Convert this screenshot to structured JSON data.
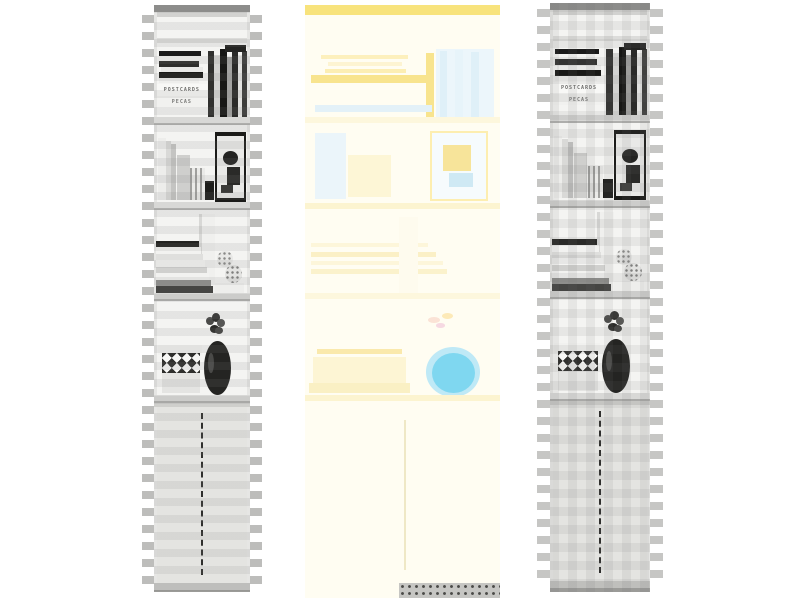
{
  "meta": {
    "description": "Photograph of a tall white bookcase shown as three side-by-side variants: left grayscale copy with horizontal block-stripe artifacts, center an over-exposed faded color copy with a yellow band at top and a cyan vase blob, right grayscale copy with checkerboard block artifacts",
    "canvas": {
      "width": 800,
      "height": 600,
      "background": "#ffffff"
    }
  },
  "palette": {
    "page_background": "#ffffff",
    "faded_cream": "#fffdf2",
    "accent_yellow": "#f8e37c",
    "vase_cyan": "#7fd7f0",
    "grayscale_light": "#f2f2f0",
    "artifact_gray": "#bdbdbb"
  },
  "photo_text": {
    "postcards_spine": "POSTCARDS",
    "pecas_spine": "PECAS"
  },
  "panels": [
    {
      "id": "left",
      "name": "bookcase-photo-grayscale-left",
      "x": 154,
      "y": 5,
      "w": 96,
      "h": 587,
      "background": "#f4f4f2",
      "items_ref": "bookcase_items",
      "overlay": "ov-hbands",
      "edge_stripes": {
        "start": 10,
        "period": 17,
        "h": 8,
        "extend": 12,
        "color": "#bdbdbb"
      }
    },
    {
      "id": "center",
      "name": "bookcase-photo-faded-center",
      "x": 305,
      "y": 5,
      "w": 195,
      "h": 593,
      "background": "#fffdf2",
      "items_ref": "faded_items",
      "overlay": null,
      "edge_stripes": null
    },
    {
      "id": "right",
      "name": "bookcase-photo-grayscale-right",
      "x": 550,
      "y": 3,
      "w": 100,
      "h": 589,
      "background": "#f4f4f2",
      "items_ref": "bookcase_items",
      "overlay": "ov-checker",
      "edge_stripes": {
        "start": 6,
        "period": 17,
        "h": 8,
        "extend": 13,
        "color": "#c6c6c4"
      }
    }
  ],
  "scene": {
    "bookcase_items": [
      {
        "n": "carcass-bg",
        "t": "rect",
        "x": 0,
        "y": 0,
        "w": 100,
        "h": 587,
        "c": "#f4f4f2"
      },
      {
        "n": "top-bar",
        "t": "rect",
        "x": 0,
        "y": 0,
        "w": 100,
        "h": 7,
        "c": "#8f8f8d"
      },
      {
        "n": "cornice-shadow",
        "t": "rect",
        "x": 0,
        "y": 7,
        "w": 100,
        "h": 5,
        "c": "#d2d2d0"
      },
      {
        "n": "top-board",
        "t": "rect",
        "x": 0,
        "y": 33,
        "w": 100,
        "h": 5,
        "c": "#dcdcda"
      },
      {
        "n": "side-wall-left",
        "t": "rect",
        "x": 0,
        "y": 7,
        "w": 3,
        "h": 580,
        "c": "#e6e6e4"
      },
      {
        "n": "side-wall-right",
        "t": "rect",
        "x": 97,
        "y": 7,
        "w": 3,
        "h": 580,
        "c": "#e6e6e4"
      },
      {
        "n": "hbook-1",
        "t": "rect",
        "x": 5,
        "y": 46,
        "w": 44,
        "h": 5,
        "c": "#1a1a1a"
      },
      {
        "n": "hbook-2",
        "t": "rect",
        "x": 5,
        "y": 51,
        "w": 46,
        "h": 5,
        "c": "#f3f3f1"
      },
      {
        "n": "hbook-3",
        "t": "rect",
        "x": 5,
        "y": 56,
        "w": 42,
        "h": 6,
        "c": "#2e2e2c"
      },
      {
        "n": "hbook-4",
        "t": "rect",
        "x": 7,
        "y": 62,
        "w": 44,
        "h": 5,
        "c": "#e9e9e7"
      },
      {
        "n": "hbook-5",
        "t": "rect",
        "x": 5,
        "y": 67,
        "w": 46,
        "h": 6,
        "c": "#191917"
      },
      {
        "n": "hbook-6",
        "t": "rect",
        "x": 5,
        "y": 73,
        "w": 42,
        "h": 5,
        "c": "#eeeeec"
      },
      {
        "n": "postcards-box",
        "t": "text",
        "x": 3,
        "y": 79,
        "w": 52,
        "h": 12,
        "c": "#f8f8f6",
        "c2": "#6e6e6c",
        "ref": "photo_text.postcards_spine",
        "fs": 5
      },
      {
        "n": "pecas-box",
        "t": "text",
        "x": 3,
        "y": 91,
        "w": 52,
        "h": 11,
        "c": "#f1f1ef",
        "c2": "#7a7a78",
        "ref": "photo_text.pecas_spine",
        "fs": 5
      },
      {
        "n": "vbook-1",
        "t": "rect",
        "x": 56,
        "y": 46,
        "w": 7,
        "h": 66,
        "c": "#30302e"
      },
      {
        "n": "vbook-2",
        "t": "rect",
        "x": 63,
        "y": 50,
        "w": 6,
        "h": 62,
        "c": "#d3d3d1"
      },
      {
        "n": "vbook-3",
        "t": "rect",
        "x": 69,
        "y": 44,
        "w": 7,
        "h": 68,
        "c": "#171715"
      },
      {
        "n": "vbook-4",
        "t": "rect",
        "x": 76,
        "y": 52,
        "w": 5,
        "h": 60,
        "c": "#a3a3a1"
      },
      {
        "n": "vbook-5",
        "t": "rect",
        "x": 81,
        "y": 47,
        "w": 6,
        "h": 65,
        "c": "#2b2b29"
      },
      {
        "n": "vbook-6",
        "t": "rect",
        "x": 87,
        "y": 50,
        "w": 5,
        "h": 62,
        "c": "#e2e2e0"
      },
      {
        "n": "vbook-7",
        "t": "rect",
        "x": 92,
        "y": 46,
        "w": 5,
        "h": 66,
        "c": "#3d3d3b"
      },
      {
        "n": "shelf1-top-box",
        "t": "rect",
        "x": 74,
        "y": 40,
        "w": 22,
        "h": 7,
        "c": "#242422"
      },
      {
        "n": "shelf-board-1",
        "t": "rect",
        "x": 0,
        "y": 112,
        "w": 100,
        "h": 8,
        "c": "#d8d8d6"
      },
      {
        "n": "shelf-board-1-edge",
        "t": "rect",
        "x": 0,
        "y": 118,
        "w": 100,
        "h": 2,
        "c": "#aeaeac"
      },
      {
        "n": "folder-1",
        "t": "rect",
        "x": 4,
        "y": 133,
        "w": 8,
        "h": 62,
        "c": "#ededeb"
      },
      {
        "n": "folder-2",
        "t": "rect",
        "x": 12,
        "y": 136,
        "w": 6,
        "h": 59,
        "c": "#d9d9d7"
      },
      {
        "n": "folder-3",
        "t": "rect",
        "x": 18,
        "y": 139,
        "w": 5,
        "h": 56,
        "c": "#c4c4c2"
      },
      {
        "n": "small-frame",
        "t": "rect",
        "x": 24,
        "y": 150,
        "w": 13,
        "h": 45,
        "c": "#cfcfcd"
      },
      {
        "n": "wire-rack",
        "t": "vstripes",
        "x": 38,
        "y": 163,
        "w": 15,
        "h": 32,
        "c": "#9f9f9d",
        "c2": "#eaeae8"
      },
      {
        "n": "dark-ornament",
        "t": "rect",
        "x": 53,
        "y": 176,
        "w": 10,
        "h": 19,
        "c": "#1d1d1b"
      },
      {
        "n": "big-frame-border",
        "t": "rect",
        "x": 64,
        "y": 127,
        "w": 32,
        "h": 70,
        "c": "#1b1b19"
      },
      {
        "n": "big-frame-mat",
        "t": "rect",
        "x": 66,
        "y": 131,
        "w": 28,
        "h": 62,
        "c": "#e9e9e7"
      },
      {
        "n": "frame-art-blob-1",
        "t": "ellipse",
        "x": 72,
        "y": 146,
        "w": 16,
        "h": 14,
        "c": "#232321"
      },
      {
        "n": "frame-art-blob-2",
        "t": "rect",
        "x": 76,
        "y": 162,
        "w": 14,
        "h": 18,
        "c": "#2a2a28"
      },
      {
        "n": "frame-art-blob-3",
        "t": "rect",
        "x": 70,
        "y": 180,
        "w": 12,
        "h": 8,
        "c": "#3a3a38"
      },
      {
        "n": "shelf-board-2",
        "t": "rect",
        "x": 0,
        "y": 197,
        "w": 100,
        "h": 8,
        "c": "#d8d8d6"
      },
      {
        "n": "shelf-board-2-edge",
        "t": "rect",
        "x": 0,
        "y": 203,
        "w": 100,
        "h": 2,
        "c": "#aeaeac"
      },
      {
        "n": "white-cylinder",
        "t": "rect",
        "x": 47,
        "y": 209,
        "w": 17,
        "h": 80,
        "c": "#f0f0ee"
      },
      {
        "n": "cylinder-shade",
        "t": "rect",
        "x": 47,
        "y": 209,
        "w": 3,
        "h": 80,
        "c": "#d8d8d6"
      },
      {
        "n": "stacked-book-1",
        "t": "rect",
        "x": 2,
        "y": 236,
        "w": 45,
        "h": 6,
        "c": "#222220"
      },
      {
        "n": "stacked-book-2",
        "t": "rect",
        "x": 2,
        "y": 242,
        "w": 47,
        "h": 7,
        "c": "#f2f2f0"
      },
      {
        "n": "stacked-book-3",
        "t": "rect",
        "x": 2,
        "y": 249,
        "w": 49,
        "h": 6,
        "c": "#dfdfdd"
      },
      {
        "n": "stacked-book-4",
        "t": "rect",
        "x": 2,
        "y": 255,
        "w": 51,
        "h": 7,
        "c": "#f5f5f3"
      },
      {
        "n": "stacked-book-5",
        "t": "rect",
        "x": 2,
        "y": 262,
        "w": 53,
        "h": 6,
        "c": "#d0d0ce"
      },
      {
        "n": "stacked-book-6",
        "t": "rect",
        "x": 2,
        "y": 268,
        "w": 55,
        "h": 7,
        "c": "#f2f2f0"
      },
      {
        "n": "stacked-book-7",
        "t": "rect",
        "x": 2,
        "y": 275,
        "w": 57,
        "h": 6,
        "c": "#8e8e8c"
      },
      {
        "n": "stacked-book-8",
        "t": "rect",
        "x": 2,
        "y": 281,
        "w": 59,
        "h": 7,
        "c": "#454543"
      },
      {
        "n": "patterned-ball-1",
        "t": "dotball",
        "x": 66,
        "y": 246,
        "w": 16,
        "h": 16,
        "c": "#e8e8e6",
        "c2": "#8a8a88"
      },
      {
        "n": "patterned-ball-2",
        "t": "dotball",
        "x": 74,
        "y": 260,
        "w": 18,
        "h": 18,
        "c": "#e3e3e1",
        "c2": "#7e7e7c"
      },
      {
        "n": "white-stack",
        "t": "rect",
        "x": 64,
        "y": 278,
        "w": 30,
        "h": 10,
        "c": "#eeeeec"
      },
      {
        "n": "shelf-board-3",
        "t": "rect",
        "x": 0,
        "y": 288,
        "w": 100,
        "h": 8,
        "c": "#d8d8d6"
      },
      {
        "n": "shelf-board-3-edge",
        "t": "rect",
        "x": 0,
        "y": 294,
        "w": 100,
        "h": 2,
        "c": "#aeaeac"
      },
      {
        "n": "backboard-tray",
        "t": "rect",
        "x": 4,
        "y": 340,
        "w": 46,
        "h": 10,
        "c": "#f1f1ef"
      },
      {
        "n": "basket-triangle-band",
        "t": "triangles",
        "x": 8,
        "y": 348,
        "w": 40,
        "h": 20,
        "c": "#2f2f2d",
        "c2": "#f7f7f5"
      },
      {
        "n": "basket-base",
        "t": "rect",
        "x": 8,
        "y": 368,
        "w": 40,
        "h": 20,
        "c": "#e4e4e2"
      },
      {
        "n": "flower-1",
        "t": "ellipse",
        "x": 54,
        "y": 312,
        "w": 8,
        "h": 8,
        "c": "#4a4a48"
      },
      {
        "n": "flower-2",
        "t": "ellipse",
        "x": 60,
        "y": 308,
        "w": 9,
        "h": 9,
        "c": "#333331"
      },
      {
        "n": "flower-3",
        "t": "ellipse",
        "x": 66,
        "y": 314,
        "w": 8,
        "h": 8,
        "c": "#575755"
      },
      {
        "n": "flower-4",
        "t": "ellipse",
        "x": 58,
        "y": 320,
        "w": 10,
        "h": 8,
        "c": "#2b2b29"
      },
      {
        "n": "flower-5",
        "t": "ellipse",
        "x": 64,
        "y": 322,
        "w": 8,
        "h": 7,
        "c": "#454543"
      },
      {
        "n": "dark-vase",
        "t": "ellipse",
        "x": 52,
        "y": 336,
        "w": 28,
        "h": 54,
        "c": "#242422"
      },
      {
        "n": "vase-highlight",
        "t": "ellipse",
        "x": 56,
        "y": 348,
        "w": 6,
        "h": 20,
        "c": "#4a4a48"
      },
      {
        "n": "shelf-board-4",
        "t": "rect",
        "x": 0,
        "y": 390,
        "w": 100,
        "h": 8,
        "c": "#d8d8d6"
      },
      {
        "n": "shelf-board-4-edge",
        "t": "rect",
        "x": 0,
        "y": 396,
        "w": 100,
        "h": 2,
        "c": "#aeaeac"
      },
      {
        "n": "cabinet-top-rail",
        "t": "rect",
        "x": 0,
        "y": 398,
        "w": 100,
        "h": 4,
        "c": "#cfcfcc"
      },
      {
        "n": "cabinet-doors",
        "t": "rect",
        "x": 3,
        "y": 402,
        "w": 94,
        "h": 176,
        "c": "#e4e4e1"
      },
      {
        "n": "door-gap-dashed-line",
        "t": "vdash",
        "x": 49,
        "y": 408,
        "w": 2,
        "h": 162,
        "c": "#2f2f2d"
      },
      {
        "n": "plinth",
        "t": "rect",
        "x": 0,
        "y": 578,
        "w": 100,
        "h": 9,
        "c": "#c8c8c5"
      },
      {
        "n": "floor-shadow",
        "t": "rect",
        "x": 0,
        "y": 585,
        "w": 100,
        "h": 4,
        "c": "#9b9b98"
      }
    ],
    "faded_items": [
      {
        "n": "faded-bg",
        "t": "rect",
        "x": 0,
        "y": 0,
        "w": 100,
        "h": 593,
        "c": "#fffdf2"
      },
      {
        "n": "yellow-top-band",
        "t": "rect",
        "x": 0,
        "y": 0,
        "w": 100,
        "h": 10,
        "c": "#f8e37c"
      },
      {
        "n": "ghost-hbook-1",
        "t": "rect",
        "x": 8,
        "y": 50,
        "w": 45,
        "h": 4,
        "c": "#fdf0bd"
      },
      {
        "n": "ghost-hbook-2",
        "t": "rect",
        "x": 12,
        "y": 57,
        "w": 38,
        "h": 4,
        "c": "#fdf4d2"
      },
      {
        "n": "ghost-hbook-3",
        "t": "rect",
        "x": 10,
        "y": 64,
        "w": 42,
        "h": 4,
        "c": "#fceeb4"
      },
      {
        "n": "ghost-yellow-band",
        "t": "rect",
        "x": 3,
        "y": 70,
        "w": 62,
        "h": 8,
        "c": "#f8e48e"
      },
      {
        "n": "ghost-yellow-vbar",
        "t": "rect",
        "x": 62,
        "y": 48,
        "w": 4,
        "h": 68,
        "c": "#f8e48e"
      },
      {
        "n": "ghost-blue-books",
        "t": "rect",
        "x": 67,
        "y": 44,
        "w": 30,
        "h": 70,
        "c": "#ecf6fb"
      },
      {
        "n": "ghost-blue-vstrip-1",
        "t": "rect",
        "x": 69,
        "y": 46,
        "w": 4,
        "h": 66,
        "c": "#dff0f8"
      },
      {
        "n": "ghost-blue-vstrip-2",
        "t": "rect",
        "x": 77,
        "y": 45,
        "w": 4,
        "h": 67,
        "c": "#e7f4fa"
      },
      {
        "n": "ghost-blue-vstrip-3",
        "t": "rect",
        "x": 85,
        "y": 47,
        "w": 4,
        "h": 65,
        "c": "#dff0f8"
      },
      {
        "n": "ghost-blue-hstrip",
        "t": "rect",
        "x": 5,
        "y": 100,
        "w": 60,
        "h": 7,
        "c": "#e3f1f8"
      },
      {
        "n": "ghost-shelf-board-1",
        "t": "rect",
        "x": 0,
        "y": 112,
        "w": 100,
        "h": 6,
        "c": "#fdf7dd"
      },
      {
        "n": "ghost-frame-left",
        "t": "rect",
        "x": 5,
        "y": 128,
        "w": 16,
        "h": 66,
        "c": "#ebf5fa"
      },
      {
        "n": "ghost-mid-shape",
        "t": "rect",
        "x": 22,
        "y": 150,
        "w": 22,
        "h": 42,
        "c": "#fdf6d6"
      },
      {
        "n": "ghost-frame-right",
        "t": "frame",
        "x": 64,
        "y": 126,
        "w": 30,
        "h": 70,
        "c": "#fdeeb0",
        "c2": "#f6fbfd"
      },
      {
        "n": "ghost-frame-art-1",
        "t": "rect",
        "x": 71,
        "y": 140,
        "w": 14,
        "h": 26,
        "c": "#f7e49a"
      },
      {
        "n": "ghost-frame-art-2",
        "t": "rect",
        "x": 74,
        "y": 168,
        "w": 12,
        "h": 14,
        "c": "#cfe9f4"
      },
      {
        "n": "ghost-shelf-board-2",
        "t": "rect",
        "x": 0,
        "y": 198,
        "w": 100,
        "h": 6,
        "c": "#fcf4d0"
      },
      {
        "n": "ghost-stack-1",
        "t": "rect",
        "x": 3,
        "y": 238,
        "w": 60,
        "h": 4,
        "c": "#fdf6da"
      },
      {
        "n": "ghost-stack-2",
        "t": "rect",
        "x": 3,
        "y": 247,
        "w": 64,
        "h": 5,
        "c": "#fbf0c6"
      },
      {
        "n": "ghost-stack-3",
        "t": "rect",
        "x": 3,
        "y": 256,
        "w": 68,
        "h": 4,
        "c": "#fdf6da"
      },
      {
        "n": "ghost-stack-4",
        "t": "rect",
        "x": 3,
        "y": 264,
        "w": 70,
        "h": 5,
        "c": "#fbf2cc"
      },
      {
        "n": "ghost-cylinder",
        "t": "rect",
        "x": 48,
        "y": 212,
        "w": 10,
        "h": 76,
        "c": "#fefbee"
      },
      {
        "n": "ghost-shelf-board-3",
        "t": "rect",
        "x": 0,
        "y": 288,
        "w": 100,
        "h": 6,
        "c": "#fdf7dd"
      },
      {
        "n": "ghost-basket-rim",
        "t": "rect",
        "x": 6,
        "y": 344,
        "w": 44,
        "h": 5,
        "c": "#fae9ac"
      },
      {
        "n": "ghost-basket-body",
        "t": "rect",
        "x": 4,
        "y": 352,
        "w": 48,
        "h": 26,
        "c": "#fdf5d4"
      },
      {
        "n": "ghost-basket-base",
        "t": "rect",
        "x": 2,
        "y": 378,
        "w": 52,
        "h": 10,
        "c": "#faf0c4"
      },
      {
        "n": "ghost-flower-1",
        "t": "ellipse",
        "x": 63,
        "y": 312,
        "w": 6,
        "h": 6,
        "c": "#fbe3d6"
      },
      {
        "n": "ghost-flower-2",
        "t": "ellipse",
        "x": 70,
        "y": 308,
        "w": 6,
        "h": 6,
        "c": "#fdeab8"
      },
      {
        "n": "ghost-flower-3",
        "t": "ellipse",
        "x": 67,
        "y": 318,
        "w": 5,
        "h": 5,
        "c": "#f6d9e2"
      },
      {
        "n": "cyan-vase-halo",
        "t": "ellipse",
        "x": 62,
        "y": 342,
        "w": 28,
        "h": 50,
        "c": "#bfe9f6"
      },
      {
        "n": "cyan-vase-blob",
        "t": "ellipse",
        "x": 65,
        "y": 348,
        "w": 22,
        "h": 40,
        "c": "#7fd7f0"
      },
      {
        "n": "ghost-shelf-board-4",
        "t": "rect",
        "x": 0,
        "y": 390,
        "w": 100,
        "h": 6,
        "c": "#fcf4d0"
      },
      {
        "n": "ghost-door-gap-line",
        "t": "rect",
        "x": 51,
        "y": 415,
        "w": 0.6,
        "h": 150,
        "c": "#efe8c6"
      },
      {
        "n": "bottom-dotted-strip",
        "t": "dots",
        "x": 48,
        "y": 578,
        "w": 52,
        "h": 15,
        "c": "#c6c6c3",
        "c2": "#4a4a48"
      }
    ]
  }
}
